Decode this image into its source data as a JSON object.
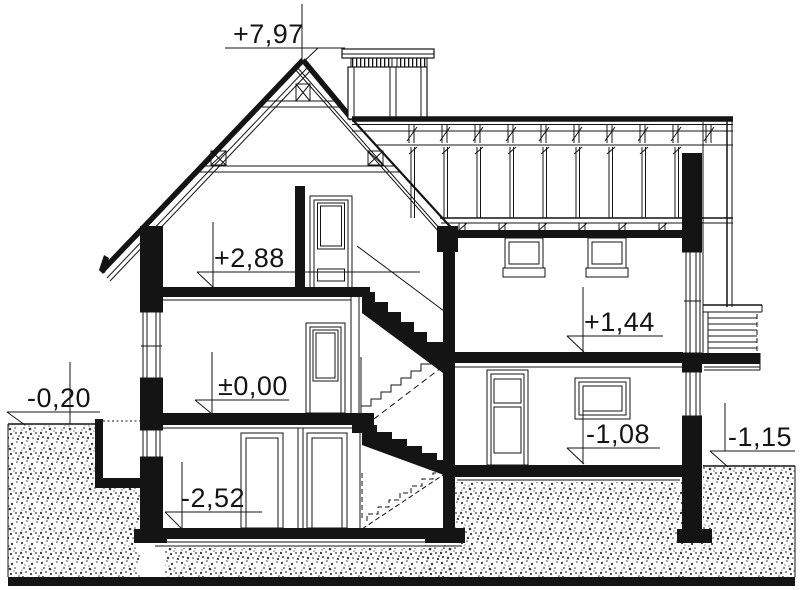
{
  "page": {
    "paper_color": "#ffffff",
    "ink_color": "#141414"
  },
  "drawing": {
    "kind": "architectural cross-section of a house"
  },
  "elevation_labels": {
    "ridge": "+7,97",
    "attic_floor": "+2,88",
    "ground_floor": "±0,00",
    "basement_floor": "-2,52",
    "ground_level_left": "-0,20",
    "mezzanine_floor": "+1,44",
    "lower_ground_floor": "-1,08",
    "ground_level_right": "-1,15"
  }
}
